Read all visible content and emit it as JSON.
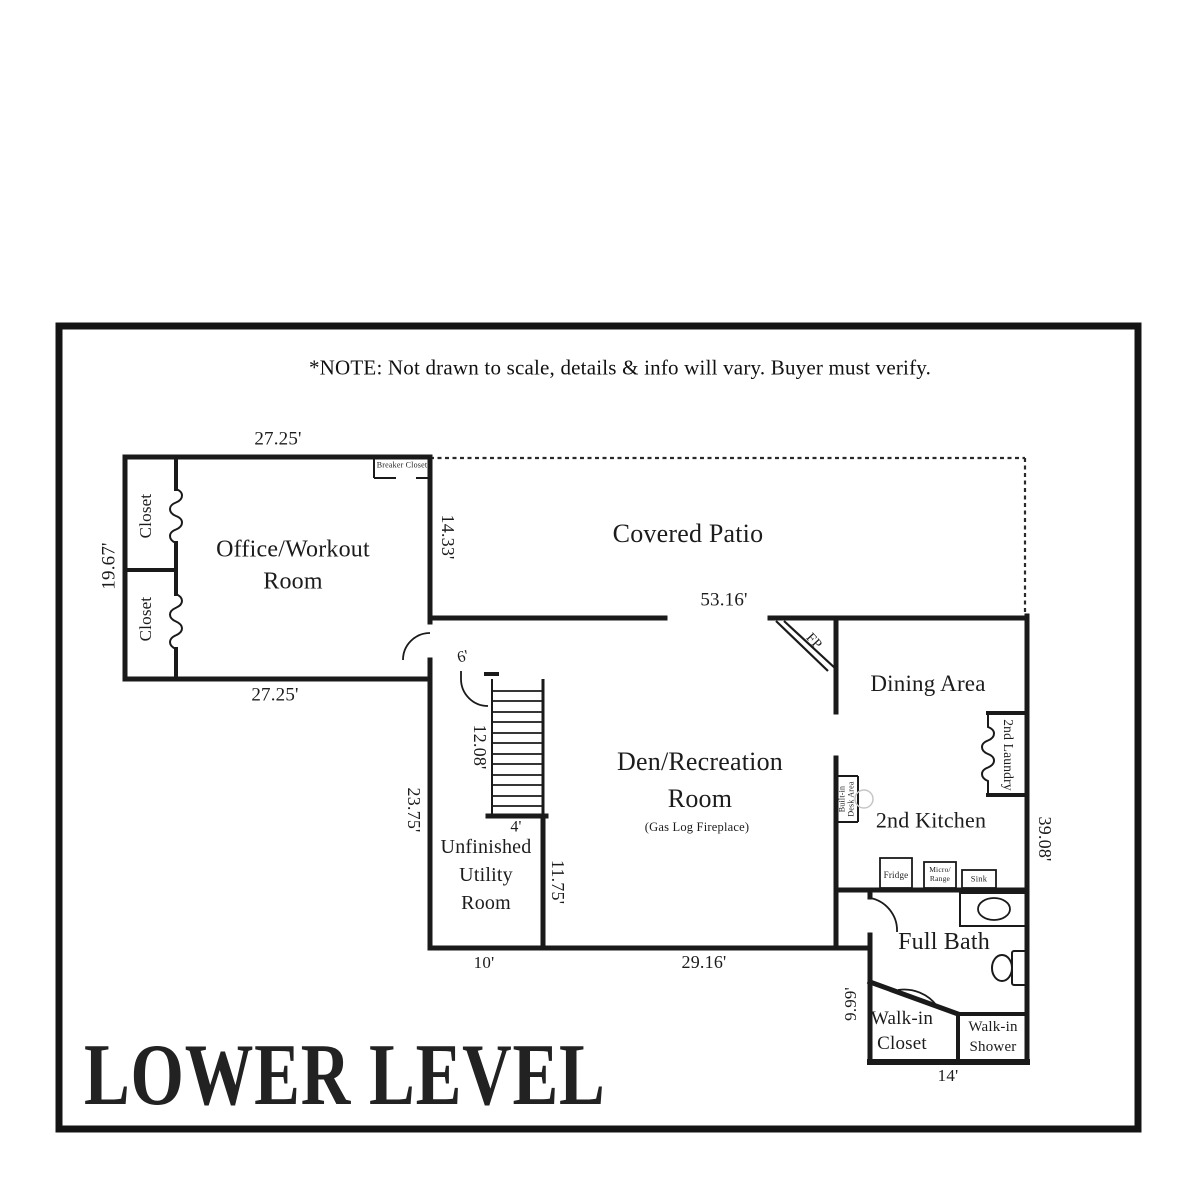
{
  "note": "*NOTE: Not drawn to scale, details & info will vary.  Buyer must verify.",
  "title": "LOWER LEVEL",
  "colors": {
    "ink": "#1a1a1a",
    "paper": "#ffffff"
  },
  "labels": {
    "office": "Office/Workout\nRoom",
    "covered_patio": "Covered Patio",
    "dining": "Dining Area",
    "den": "Den/Recreation\nRoom",
    "den_sub": "(Gas Log Fireplace)",
    "kitchen": "2nd Kitchen",
    "utility": "Unfinished\nUtility\nRoom",
    "full_bath": "Full Bath",
    "walkin_closet": "Walk-in\nCloset",
    "walkin_shower": "Walk-in\nShower",
    "laundry": "2nd Laundry",
    "desk": "Built-in\nDesk Area",
    "breaker": "Breaker Closet",
    "closet_upper": "Closet",
    "closet_lower": "Closet",
    "fireplace": "FP",
    "fridge": "Fridge",
    "micro_range": "Micro/\nRange",
    "sink": "Sink"
  },
  "dimensions": {
    "office_top": "27.25'",
    "office_bottom": "27.25'",
    "office_left": "19.67'",
    "office_right": "14.33'",
    "patio_width": "53.16'",
    "door": "6'",
    "stairs_length": "12.08'",
    "stairs_width": "4'",
    "utility_left": "23.75'",
    "utility_right": "11.75'",
    "utility_bottom": "10'",
    "den_bottom": "29.16'",
    "east_side": "39.08'",
    "bath_closet_left": "9.99'",
    "bath_closet_bottom": "14'"
  }
}
